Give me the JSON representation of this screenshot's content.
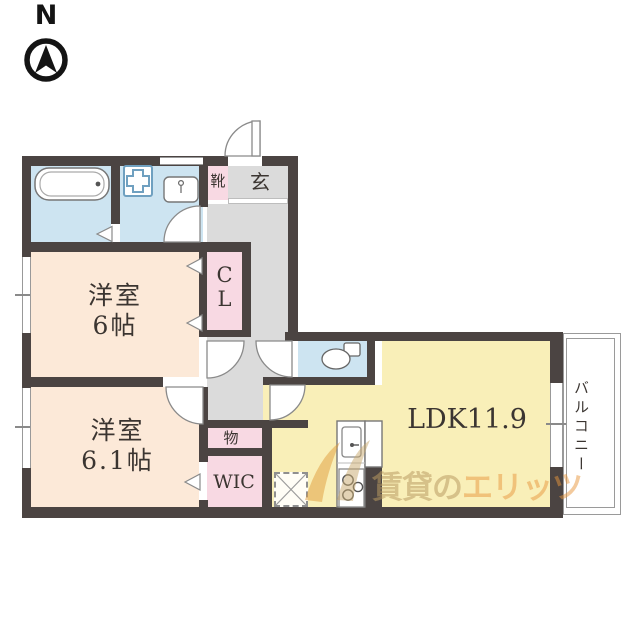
{
  "compass": {
    "label": "N"
  },
  "rooms": {
    "western_room_1": {
      "name": "洋室",
      "size": "6帖"
    },
    "western_room_2": {
      "name": "洋室",
      "size": "6.1帖"
    },
    "ldk": {
      "label": "LDK11.9"
    },
    "closet": {
      "label": "CL"
    },
    "walk_in_closet": {
      "label": "WIC"
    },
    "storage": {
      "label": "物"
    },
    "entrance": {
      "label": "玄"
    },
    "shoe_cabinet": {
      "label": "靴"
    },
    "balcony": {
      "label": "バルコニー"
    }
  },
  "fixtures": {
    "north_arrow": "north-arrow-icon",
    "bathtub": "bathtub-icon",
    "washing_machine_pan": "washing-machine-pan-icon",
    "washbasin": "washbasin-icon",
    "toilet": "toilet-icon",
    "kitchen_sink": "kitchen-sink-icon",
    "stove": "stove-icon",
    "refrigerator_space": "refrigerator-space-icon"
  },
  "watermark": {
    "prefix": "賃貸の",
    "brand": "エリッツ"
  },
  "colors": {
    "wall": "#4b4442",
    "wet_area_blue": "#cde4f1",
    "room_peach": "#fce9d8",
    "ldk_yellow": "#f9efb8",
    "closet_pink": "#f8d9e3",
    "hall_gray": "#dbdbdb",
    "watermark_tan": "#b99b62",
    "watermark_orange": "#e8963c"
  }
}
